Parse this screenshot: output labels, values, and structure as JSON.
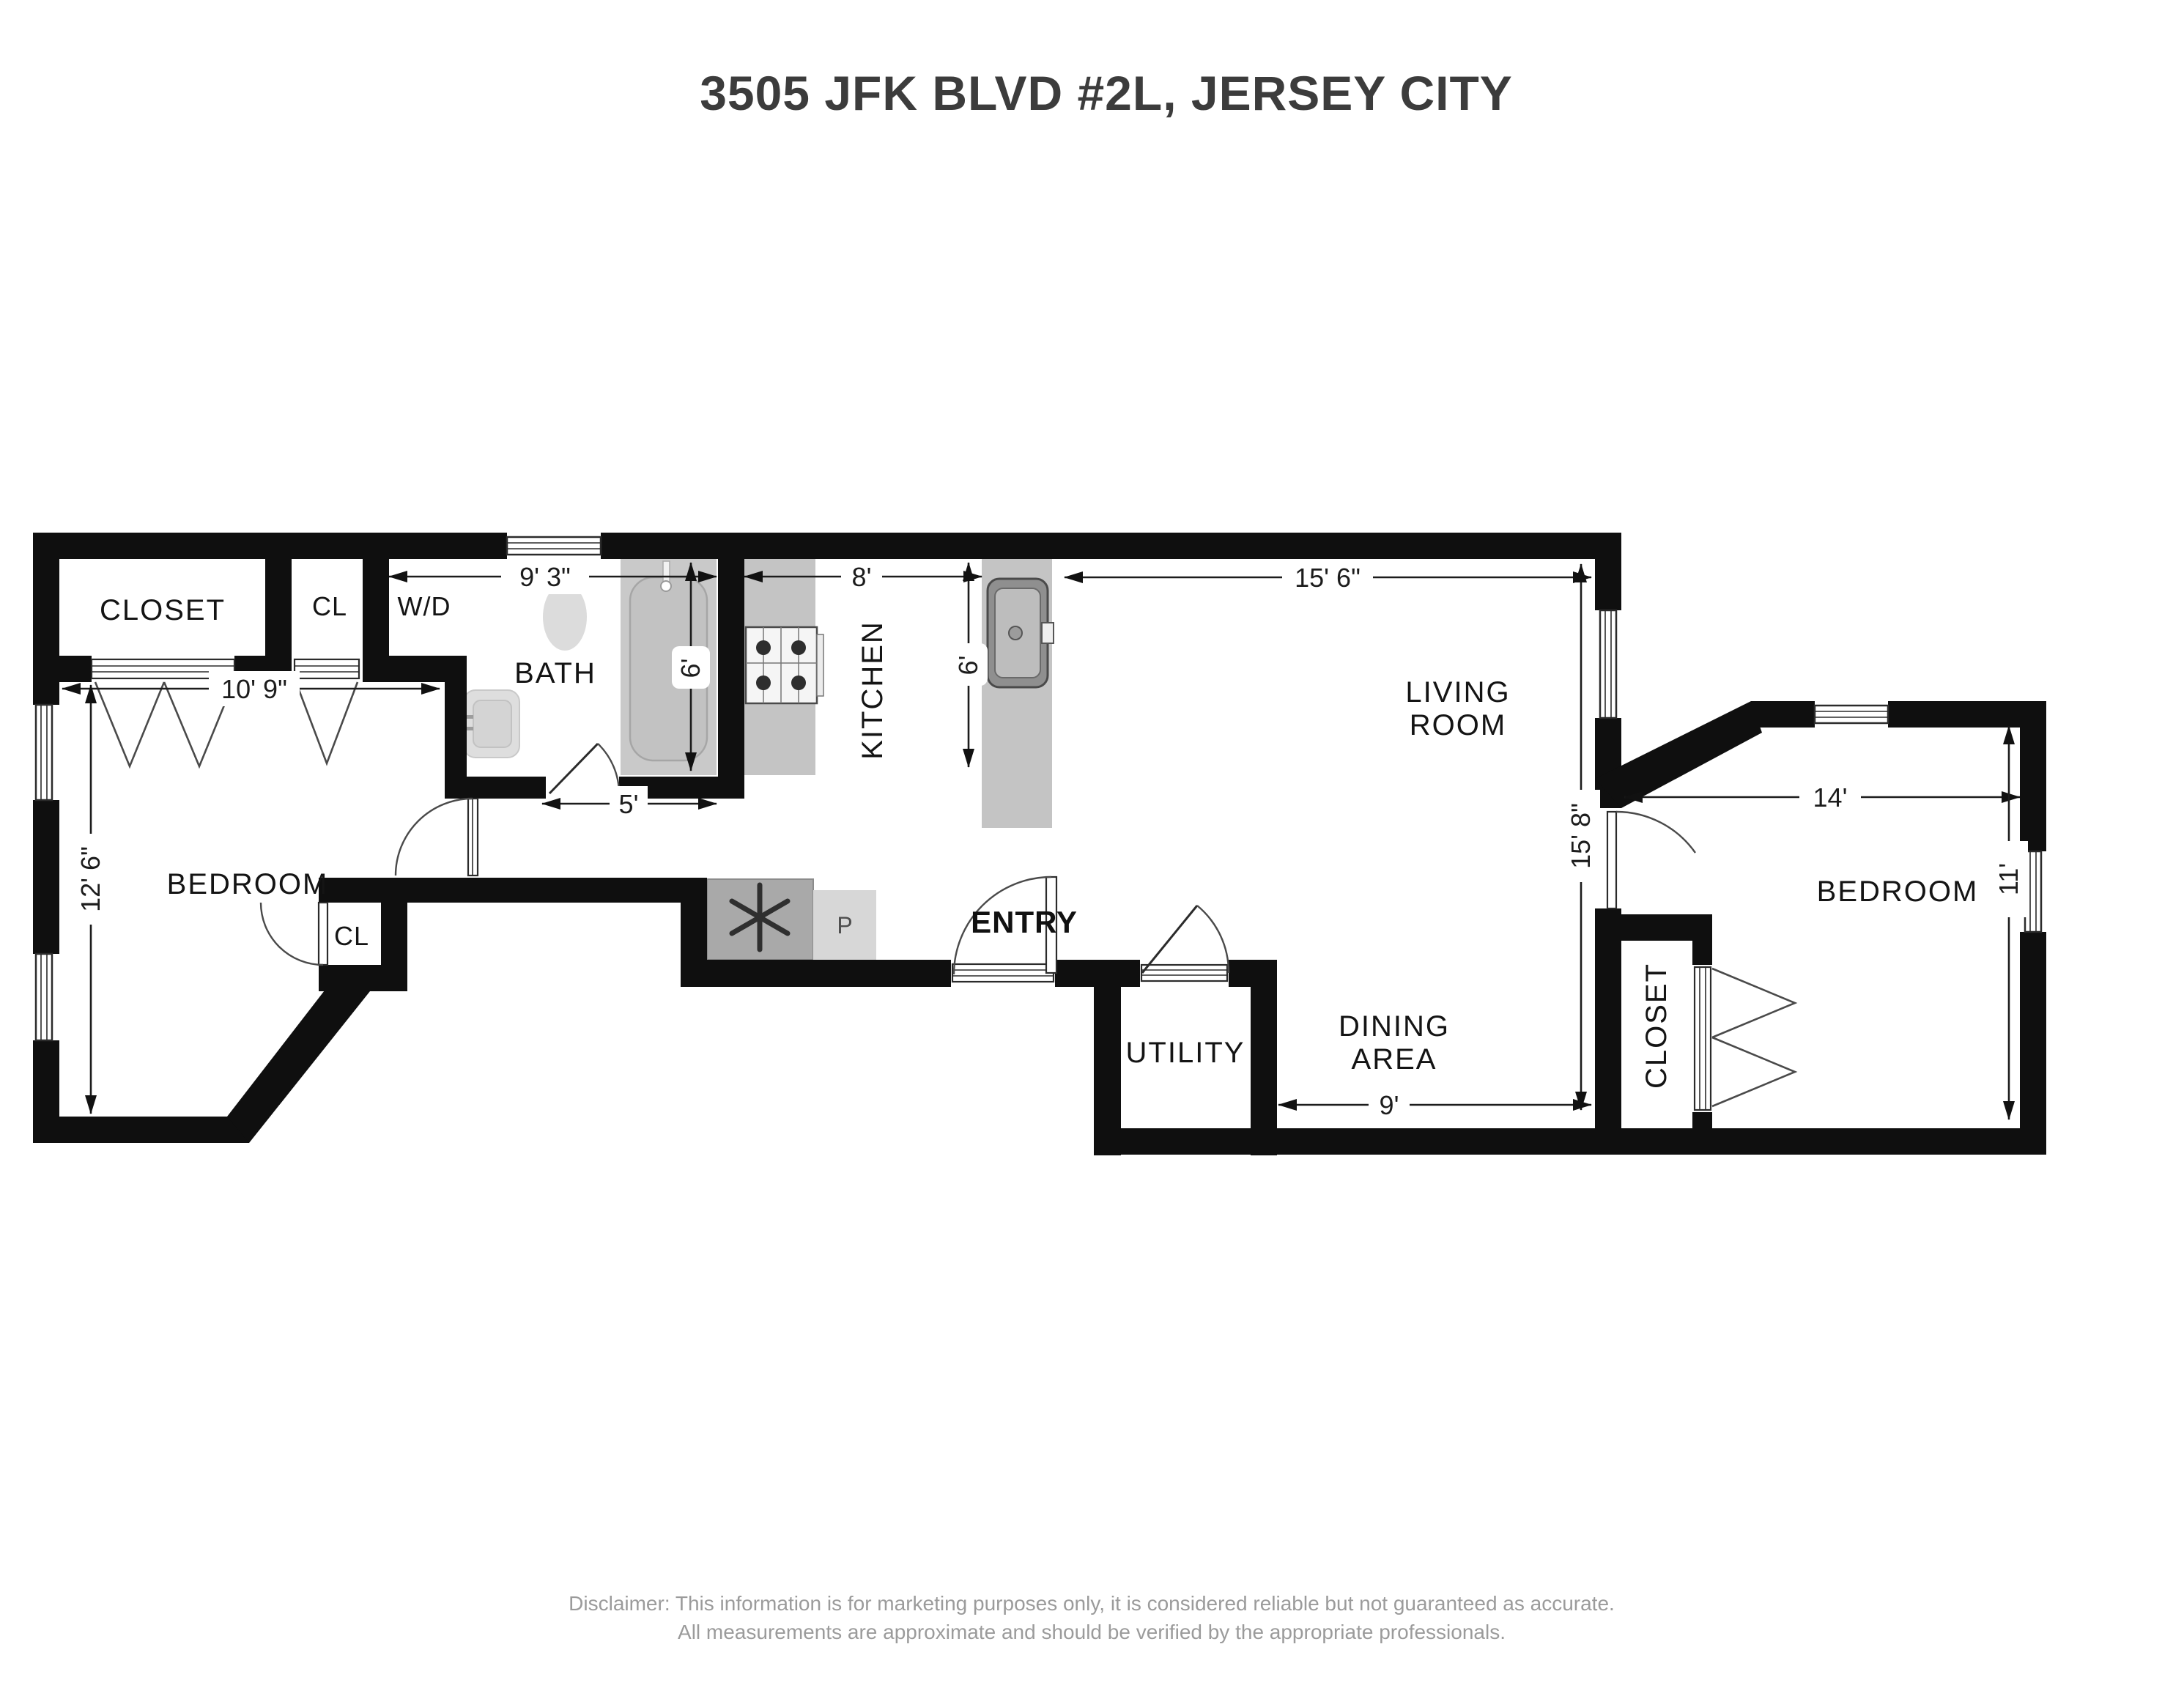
{
  "title": "3505 JFK BLVD #2L, JERSEY CITY",
  "rooms": {
    "closet_top": "CLOSET",
    "cl_top": "CL",
    "wd": "W/D",
    "bath": "BATH",
    "kitchen": "KITCHEN",
    "living_line1": "LIVING",
    "living_line2": "ROOM",
    "bedroom_left": "BEDROOM",
    "cl_bedroom": "CL",
    "entry": "ENTRY",
    "utility": "UTILITY",
    "dining_line1": "DINING",
    "dining_line2": "AREA",
    "closet_right": "CLOSET",
    "bedroom_right": "BEDROOM"
  },
  "dimensions": {
    "closet_row_width": "10' 9\"",
    "bath_section_width": "9' 3\"",
    "kitchen_width": "8'",
    "living_width": "15' 6\"",
    "bath_depth": "6'",
    "kitchen_counter_depth": "6'",
    "hall_width": "5'",
    "bedroom_left_depth": "12' 6\"",
    "living_depth": "15' 8\"",
    "bedroom_right_width": "14'",
    "bedroom_right_depth": "11'",
    "dining_width": "9'"
  },
  "appliances": {
    "pantry_label": "P"
  },
  "icons": {
    "fan": "fan-icon",
    "stove": "stove-icon",
    "kitchen_sink": "sink-icon",
    "toilet": "toilet-icon",
    "bathtub": "bathtub-icon",
    "bath_sink": "bath-sink-icon"
  },
  "disclaimer": {
    "line1": "Disclaimer: This information is for marketing purposes only, it is considered reliable but not guaranteed as accurate.",
    "line2": "All measurements are approximate and should be verified by the appropriate professionals."
  },
  "colors": {
    "wall": "#0f0f0f",
    "counter": "#c4c4c4",
    "counter_dark": "#a9a9a9",
    "counter_light": "#d7d7d7",
    "fixture": "#dcdcdc",
    "tub": "#c9c9c9",
    "label": "#141414",
    "title": "#3c3c3c",
    "disclaimer": "#9b9b9b"
  }
}
